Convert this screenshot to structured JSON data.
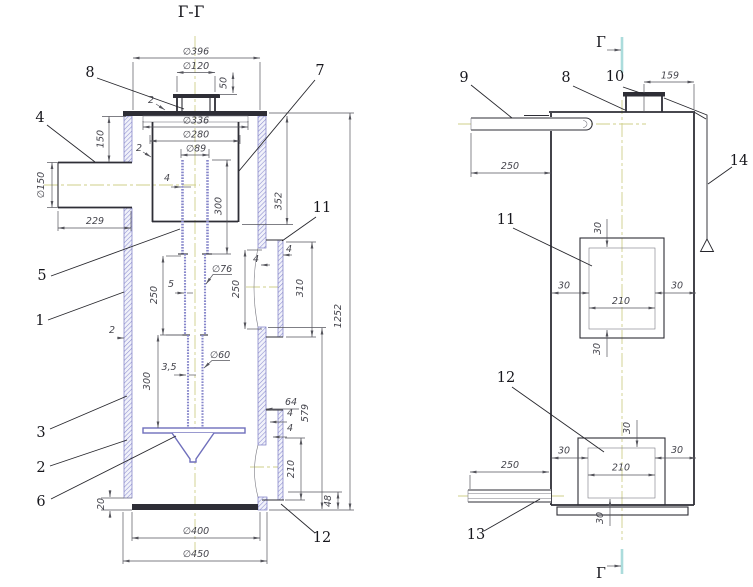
{
  "drawing": {
    "section_title": "Г-Г",
    "section_letter_top": "Г",
    "section_letter_bottom": "Г"
  },
  "left_view": {
    "dims": {
      "d396": "∅396",
      "d120": "∅120",
      "h50": "50",
      "t2_top": "2",
      "d336": "∅336",
      "d280": "∅280",
      "d89": "∅89",
      "t2_shell": "2",
      "h150": "150",
      "d150": "∅150",
      "w229": "229",
      "t4_pipe": "4",
      "h352": "352",
      "h300_upper": "300",
      "h250_pipe": "250",
      "t5": "5",
      "d76": "∅76",
      "h250_opening": "250",
      "h310": "310",
      "t4_sleeve_a": "4",
      "t4_sleeve_b": "4",
      "t2_wall": "2",
      "h300_lower": "300",
      "t35": "3,5",
      "d60": "∅60",
      "w64": "64",
      "t4_lower_a": "4",
      "t4_lower_b": "4",
      "h579": "579",
      "h210": "210",
      "h48": "48",
      "h1252": "1252",
      "h20": "20",
      "d400": "∅400",
      "d450": "∅450"
    },
    "callouts": {
      "c1": "1",
      "c2": "2",
      "c3": "3",
      "c4": "4",
      "c5": "5",
      "c6": "6",
      "c7": "7",
      "c8": "8",
      "c11": "11",
      "c12": "12"
    }
  },
  "right_view": {
    "dims": {
      "w159": "159",
      "w250_top": "250",
      "w250_bottom": "250",
      "win1_top": "30",
      "win1_left": "30",
      "win1_right": "30",
      "win1_width": "210",
      "win1_bottom": "30",
      "win2_top": "30",
      "win2_left": "30",
      "win2_right": "30",
      "win2_width": "210",
      "win2_bottom": "30"
    },
    "callouts": {
      "c8": "8",
      "c9": "9",
      "c10": "10",
      "c11": "11",
      "c12": "12",
      "c13": "13",
      "c14": "14"
    }
  },
  "colors": {
    "outline": "#2e2e36",
    "dimension": "#55555c",
    "wall_hatch": "#8b8bcf",
    "centerline": "#cfcf8a",
    "section_mark": "#abdcdc",
    "background": "#ffffff"
  }
}
